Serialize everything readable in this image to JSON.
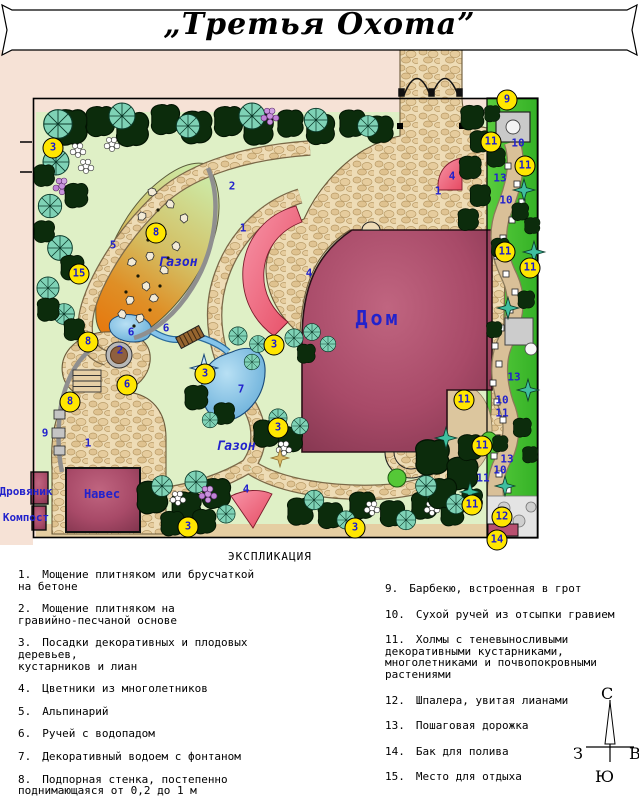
{
  "title": {
    "text": "„Третья Охота”"
  },
  "plan": {
    "area_labels": [
      {
        "text": "Дом",
        "x": 378,
        "y": 318,
        "cls": "lbl-house"
      },
      {
        "text": "Газон",
        "x": 178,
        "y": 263,
        "cls": "lbl-lawn"
      },
      {
        "text": "Газон",
        "x": 236,
        "y": 447,
        "cls": "lbl-lawn"
      },
      {
        "text": "Навес",
        "x": 102,
        "y": 494,
        "cls": "lbl-struct"
      },
      {
        "text": "Дровяник",
        "x": 26,
        "y": 492,
        "cls": "lbl-struct-sm"
      },
      {
        "text": "Компост",
        "x": 26,
        "y": 518,
        "cls": "lbl-struct-sm"
      }
    ],
    "markers": [
      {
        "n": "3",
        "x": 53,
        "y": 148
      },
      {
        "n": "15",
        "x": 79,
        "y": 274
      },
      {
        "n": "8",
        "x": 156,
        "y": 233
      },
      {
        "n": "8",
        "x": 88,
        "y": 342
      },
      {
        "n": "8",
        "x": 70,
        "y": 402
      },
      {
        "n": "6",
        "x": 127,
        "y": 385
      },
      {
        "n": "3",
        "x": 274,
        "y": 345
      },
      {
        "n": "3",
        "x": 205,
        "y": 374
      },
      {
        "n": "3",
        "x": 278,
        "y": 428
      },
      {
        "n": "3",
        "x": 188,
        "y": 527
      },
      {
        "n": "3",
        "x": 355,
        "y": 528
      },
      {
        "n": "9",
        "x": 507,
        "y": 100
      },
      {
        "n": "11",
        "x": 491,
        "y": 142
      },
      {
        "n": "11",
        "x": 525,
        "y": 166
      },
      {
        "n": "11",
        "x": 505,
        "y": 252
      },
      {
        "n": "11",
        "x": 530,
        "y": 268
      },
      {
        "n": "11",
        "x": 464,
        "y": 400
      },
      {
        "n": "11",
        "x": 482,
        "y": 446
      },
      {
        "n": "11",
        "x": 472,
        "y": 505
      },
      {
        "n": "12",
        "x": 502,
        "y": 517
      },
      {
        "n": "14",
        "x": 497,
        "y": 540
      }
    ],
    "numbers": [
      {
        "n": "1",
        "x": 438,
        "y": 191
      },
      {
        "n": "1",
        "x": 243,
        "y": 228
      },
      {
        "n": "1",
        "x": 88,
        "y": 443
      },
      {
        "n": "2",
        "x": 232,
        "y": 186
      },
      {
        "n": "2",
        "x": 120,
        "y": 350
      },
      {
        "n": "4",
        "x": 452,
        "y": 176
      },
      {
        "n": "4",
        "x": 309,
        "y": 273
      },
      {
        "n": "4",
        "x": 246,
        "y": 489
      },
      {
        "n": "5",
        "x": 113,
        "y": 245
      },
      {
        "n": "6",
        "x": 131,
        "y": 332
      },
      {
        "n": "6",
        "x": 166,
        "y": 328
      },
      {
        "n": "7",
        "x": 241,
        "y": 389
      },
      {
        "n": "9",
        "x": 45,
        "y": 433
      },
      {
        "n": "10",
        "x": 518,
        "y": 143
      },
      {
        "n": "10",
        "x": 506,
        "y": 200
      },
      {
        "n": "10",
        "x": 502,
        "y": 400
      },
      {
        "n": "10",
        "x": 500,
        "y": 470
      },
      {
        "n": "11",
        "x": 502,
        "y": 413
      },
      {
        "n": "11",
        "x": 483,
        "y": 478
      },
      {
        "n": "13",
        "x": 500,
        "y": 178
      },
      {
        "n": "13",
        "x": 514,
        "y": 377
      },
      {
        "n": "13",
        "x": 507,
        "y": 459
      }
    ]
  },
  "legend": {
    "heading": "ЭКСПЛИКАЦИЯ",
    "left": [
      {
        "num": "1.",
        "text": "Мощение плитняком или брусчаткой\nна бетоне"
      },
      {
        "num": "2.",
        "text": "Мощение плитняком на\nгравийно-песчаной основе"
      },
      {
        "num": "3.",
        "text": "Посадки декоративных и плодовых\nдеревьев,\nкустарников и лиан"
      },
      {
        "num": "4.",
        "text": "Цветники из многолетников"
      },
      {
        "num": "5.",
        "text": "Альпинарий"
      },
      {
        "num": "6.",
        "text": "Ручей с водопадом"
      },
      {
        "num": "7.",
        "text": "Декоративный водоем с фонтаном"
      },
      {
        "num": "8.",
        "text": "Подпорная стенка, постепенно\nподнимающаяся от 0,2 до 1 м"
      }
    ],
    "right": [
      {
        "num": "9.",
        "text": "Барбекю, встроенная в грот"
      },
      {
        "num": "10.",
        "text": "Сухой ручей из отсыпки гравием"
      },
      {
        "num": "11.",
        "text": "Холмы с теневыносливыми\nдекоративными кустарниками,\nмноголетниками и почвопокровными\nрастениями"
      },
      {
        "num": "12.",
        "text": "Шпалера, увитая лианами"
      },
      {
        "num": "13.",
        "text": "Пошаговая дорожка"
      },
      {
        "num": "14.",
        "text": "Бак для полива"
      },
      {
        "num": "15.",
        "text": "Место для отдыха"
      }
    ]
  },
  "compass": {
    "north": "С",
    "south": "Ю",
    "west": "З",
    "east": "В"
  },
  "colors": {
    "marker_yellow": "#ffe600",
    "label_blue": "#2222cc",
    "house_pink": "#a84a68",
    "lawn_green": "#dff0c6",
    "paving_tan": "#eedcb6",
    "strip_green": "#49c431",
    "water_blue": "#5ea8d6",
    "margin_peach": "#f6e2d6"
  }
}
